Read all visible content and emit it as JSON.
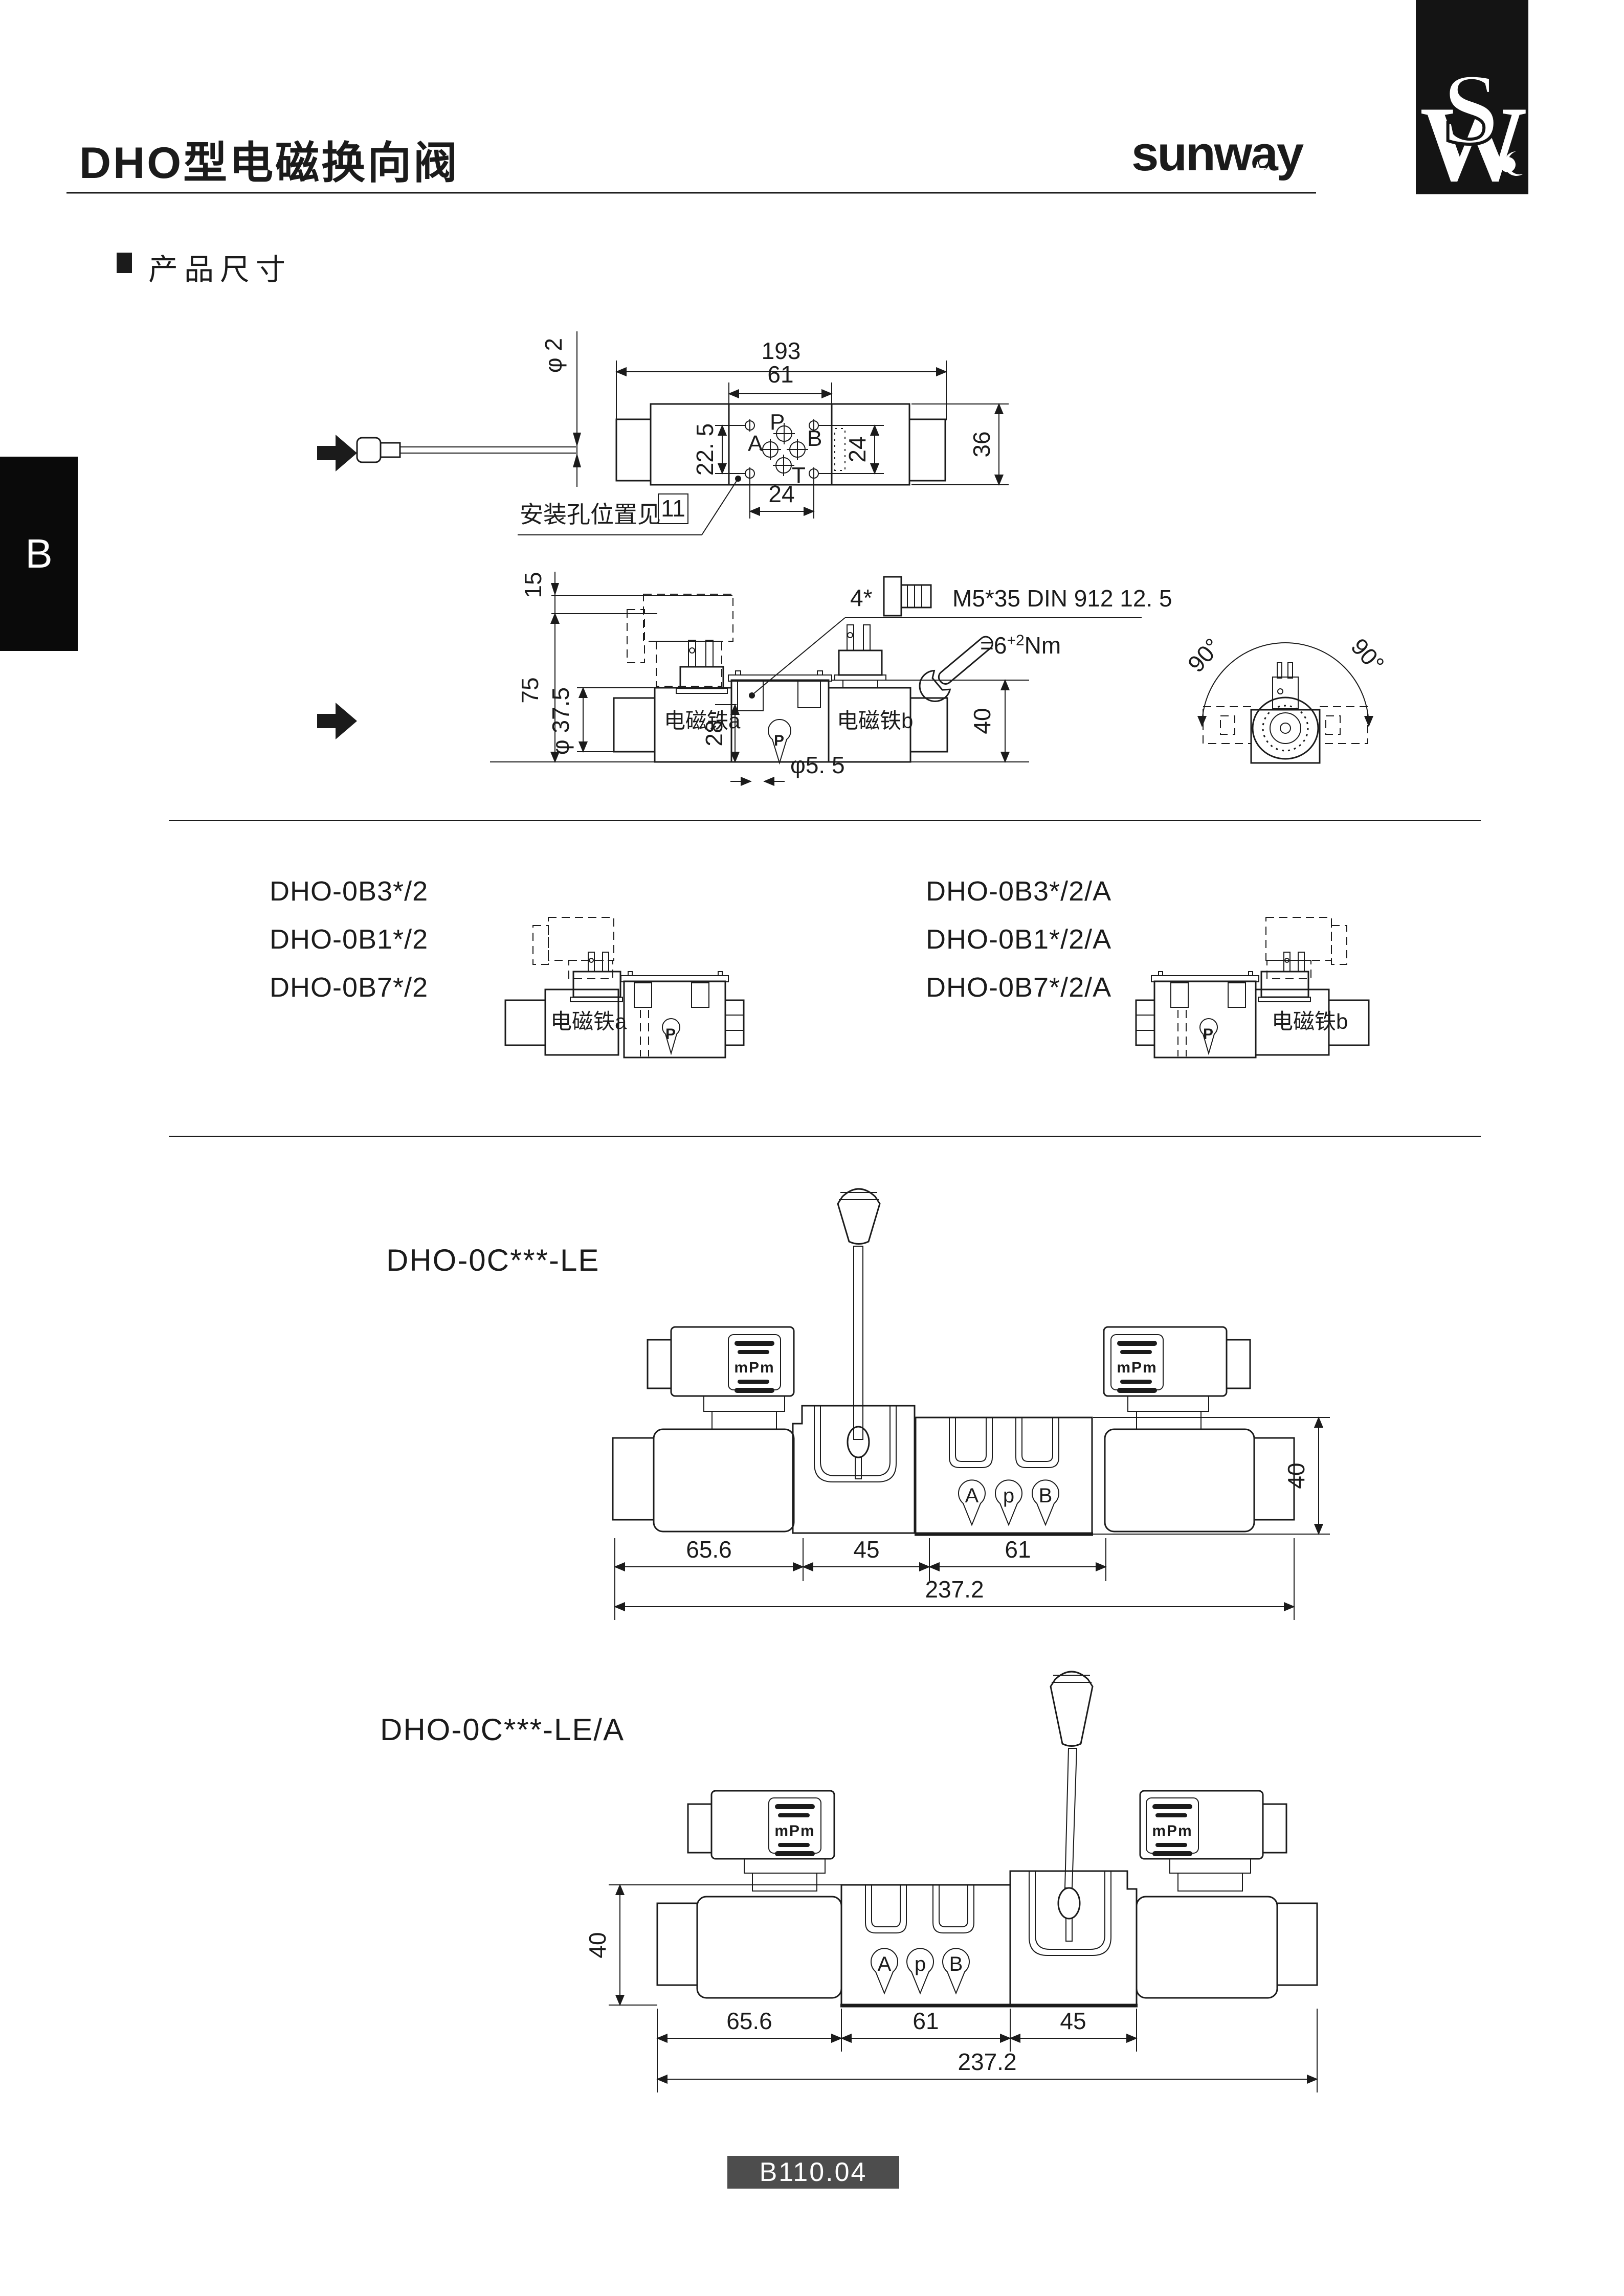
{
  "page": {
    "side_tab": "B",
    "footer_code": "B110.04"
  },
  "header": {
    "title": "DHO型电磁换向阀",
    "brand_wordmark": "sunway",
    "brand_star": "★",
    "brand_monogram_s": "S",
    "brand_monogram_w": "W"
  },
  "section": {
    "heading": "产品尺寸"
  },
  "top_view": {
    "dia_cable": "φ 2",
    "dim_total": "193",
    "dim_center": "61",
    "dim_left": "22. 5",
    "dim_right_v": "24",
    "dim_bottom": "24",
    "dim_height": "36",
    "port_p": "P",
    "port_a": "A",
    "port_b": "B",
    "port_t": "T",
    "note_text": "安装孔位置见",
    "note_ref": "11"
  },
  "front_view": {
    "dim_15": "15",
    "dim_75": "75",
    "dia_coil": "φ 37.5",
    "dim_28": "28",
    "dia_hole": "φ5. 5",
    "dim_40": "40",
    "solenoid_a": "电磁铁a",
    "solenoid_b": "电磁铁b",
    "port_p": "P",
    "screw_qty": "4*",
    "screw_spec": "M5*35  DIN 912 12. 5",
    "torque_prefix": "=6",
    "torque_sup": "+2",
    "torque_unit": "Nm",
    "angle_left": "90°",
    "angle_right": "90°"
  },
  "variants": {
    "left": {
      "models": [
        "DHO-0B3*/2",
        "DHO-0B1*/2",
        "DHO-0B7*/2"
      ],
      "solenoid_label": "电磁铁a",
      "port": "P"
    },
    "right": {
      "models": [
        "DHO-0B3*/2/A",
        "DHO-0B1*/2/A",
        "DHO-0B7*/2/A"
      ],
      "solenoid_label": "电磁铁b",
      "port": "P"
    }
  },
  "lever_valve": {
    "model": "DHO-0C***-LE",
    "connector_mark": "mPm",
    "port_a": "A",
    "port_p": "p",
    "port_b": "B",
    "dim_seg1": "65.6",
    "dim_seg2": "45",
    "dim_seg3": "61",
    "dim_total": "237.2",
    "dim_height": "40"
  },
  "lever_valve_a": {
    "model": "DHO-0C***-LE/A",
    "connector_mark": "mPm",
    "port_a": "A",
    "port_p": "p",
    "port_b": "B",
    "dim_seg1": "65.6",
    "dim_seg2": "61",
    "dim_seg3": "45",
    "dim_total": "237.2",
    "dim_height": "40"
  }
}
